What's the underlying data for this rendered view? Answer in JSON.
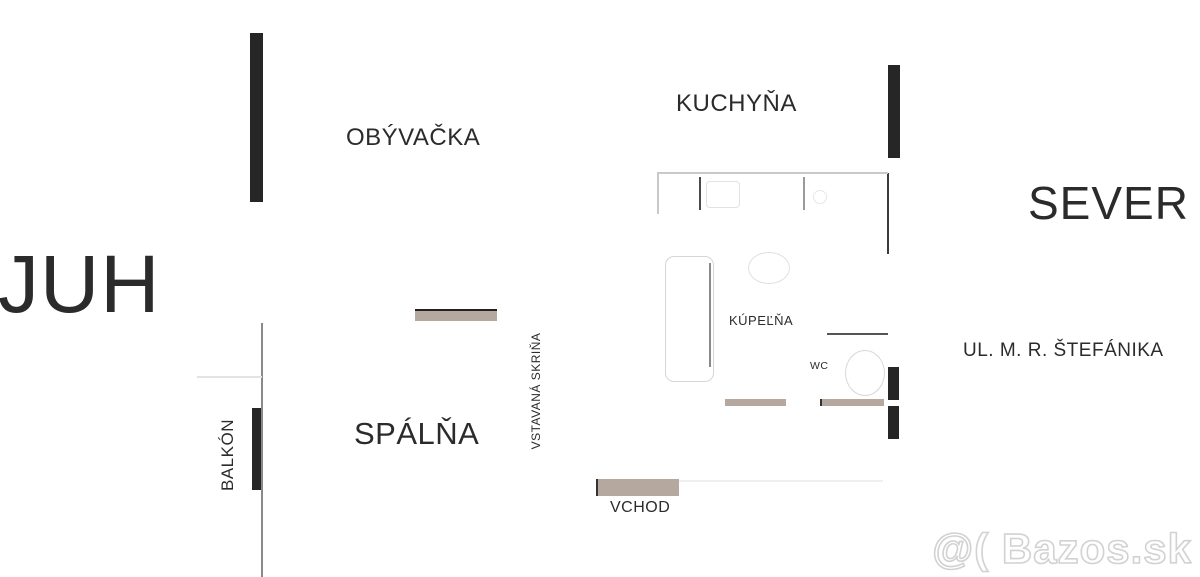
{
  "plan": {
    "compass": {
      "south": "JUH",
      "north": "SEVER"
    },
    "street": "UL. M. R. ŠTEFÁNIKA",
    "rooms": {
      "living_room": "OBÝVAČKA",
      "kitchen": "KUCHYŇA",
      "bathroom": "KÚPEĽŇA",
      "wc": "WC",
      "bedroom": "SPÁLŇA",
      "balcony": "BALKÓN",
      "built_in_wardrobe": "VSTAVANÁ SKRIŇA",
      "entrance": "VCHOD"
    },
    "colors": {
      "wall": "#262626",
      "door_opening": "#b4a89f",
      "text": "#2b2b2b",
      "thin_line": "#8a8a8a",
      "fixture_outline": "#d2d2d2",
      "watermark": "#d2d2d2",
      "background": "#ffffff"
    }
  },
  "watermark": {
    "text": "@( Bazos.sk"
  }
}
